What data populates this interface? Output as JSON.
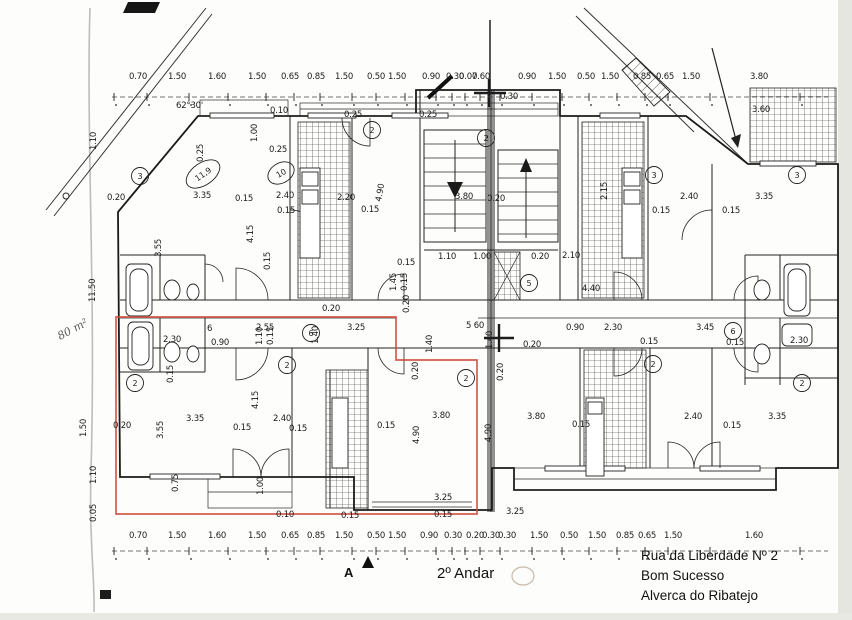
{
  "footer": {
    "floor_title": "2º Andar",
    "address1": "Rua da Liberdade Nº 2",
    "address2": "Bom Sucesso",
    "address3": "Alverca do Ribatejo"
  },
  "dimensions": {
    "tick_xs": [
      114,
      147,
      189,
      228,
      266,
      294,
      320,
      352,
      376,
      405,
      436,
      452,
      465,
      480,
      500,
      532,
      562,
      589,
      617,
      645,
      668,
      710,
      800
    ],
    "top": {
      "text_y": 79,
      "line_y": 97,
      "items": [
        {
          "t": "0.70",
          "x": 129
        },
        {
          "t": "1.50",
          "x": 168
        },
        {
          "t": "1.60",
          "x": 208
        },
        {
          "t": "1.50",
          "x": 248
        },
        {
          "t": "0.65",
          "x": 281
        },
        {
          "t": "0.85",
          "x": 307
        },
        {
          "t": "1.50",
          "x": 335
        },
        {
          "t": "0.50",
          "x": 367
        },
        {
          "t": "1.50",
          "x": 388
        },
        {
          "t": "0.90",
          "x": 422
        },
        {
          "t": "0.30",
          "x": 446
        },
        {
          "t": "0.07",
          "x": 459
        },
        {
          "t": "0.60",
          "x": 472
        },
        {
          "t": "0.90",
          "x": 518
        },
        {
          "t": "1.50",
          "x": 548
        },
        {
          "t": "0.50",
          "x": 577
        },
        {
          "t": "1.50",
          "x": 601
        },
        {
          "t": "0.85",
          "x": 633
        },
        {
          "t": "0.65",
          "x": 656
        },
        {
          "t": "1.50",
          "x": 682
        },
        {
          "t": "3.80",
          "x": 750
        }
      ]
    },
    "bottom": {
      "text_y": 538,
      "line_y": 551,
      "items": [
        {
          "t": "0.70",
          "x": 129
        },
        {
          "t": "1.50",
          "x": 168
        },
        {
          "t": "1.60",
          "x": 208
        },
        {
          "t": "1.50",
          "x": 248
        },
        {
          "t": "0.65",
          "x": 281
        },
        {
          "t": "0.85",
          "x": 307
        },
        {
          "t": "1.50",
          "x": 335
        },
        {
          "t": "0.50",
          "x": 367
        },
        {
          "t": "1.50",
          "x": 388
        },
        {
          "t": "0.90",
          "x": 420
        },
        {
          "t": "0.30",
          "x": 444
        },
        {
          "t": "0.20",
          "x": 466
        },
        {
          "t": "0.30",
          "x": 482
        },
        {
          "t": "0.30",
          "x": 498
        },
        {
          "t": "1.50",
          "x": 530
        },
        {
          "t": "0.50",
          "x": 560
        },
        {
          "t": "1.50",
          "x": 588
        },
        {
          "t": "0.85",
          "x": 616
        },
        {
          "t": "0.65",
          "x": 638
        },
        {
          "t": "1.50",
          "x": 664
        },
        {
          "t": "1.60",
          "x": 745
        }
      ]
    }
  },
  "plan": {
    "labels": [
      {
        "t": "62°30'",
        "x": 176,
        "y": 108
      },
      {
        "t": "1.10",
        "x": 96,
        "y": 150,
        "r": -90
      },
      {
        "t": "0.25",
        "x": 203,
        "y": 162,
        "r": -90
      },
      {
        "t": "0.10",
        "x": 270,
        "y": 113
      },
      {
        "t": "1.00",
        "x": 257,
        "y": 142,
        "r": -90
      },
      {
        "t": "0.25",
        "x": 269,
        "y": 152
      },
      {
        "t": "0.25",
        "x": 344,
        "y": 117
      },
      {
        "t": "0.25",
        "x": 419,
        "y": 117
      },
      {
        "t": "0.30",
        "x": 500,
        "y": 99
      },
      {
        "t": "3.60",
        "x": 752,
        "y": 112
      },
      {
        "t": "0.20",
        "x": 107,
        "y": 200
      },
      {
        "t": "3.35",
        "x": 193,
        "y": 198
      },
      {
        "t": "0.15",
        "x": 235,
        "y": 201
      },
      {
        "t": "2.40",
        "x": 276,
        "y": 198
      },
      {
        "t": "0.15",
        "x": 277,
        "y": 213
      },
      {
        "t": "2.20",
        "x": 337,
        "y": 200
      },
      {
        "t": "0.15",
        "x": 361,
        "y": 212
      },
      {
        "t": "4.90",
        "x": 381,
        "y": 202,
        "r": -80
      },
      {
        "t": "3.80",
        "x": 455,
        "y": 199
      },
      {
        "t": "0.20",
        "x": 487,
        "y": 201
      },
      {
        "t": "2.15",
        "x": 607,
        "y": 200,
        "r": -90
      },
      {
        "t": "2.40",
        "x": 680,
        "y": 199
      },
      {
        "t": "0.15",
        "x": 652,
        "y": 213
      },
      {
        "t": "3.35",
        "x": 755,
        "y": 199
      },
      {
        "t": "0.15",
        "x": 722,
        "y": 213
      },
      {
        "t": "3.55",
        "x": 161,
        "y": 257,
        "r": -90
      },
      {
        "t": "4.15",
        "x": 253,
        "y": 243,
        "r": -90
      },
      {
        "t": "0.15",
        "x": 270,
        "y": 270,
        "r": -90
      },
      {
        "t": "4.40",
        "x": 582,
        "y": 291
      },
      {
        "t": "1.10",
        "x": 438,
        "y": 259
      },
      {
        "t": "1.00",
        "x": 473,
        "y": 259
      },
      {
        "t": "0.20",
        "x": 531,
        "y": 259
      },
      {
        "t": "2.10",
        "x": 562,
        "y": 258
      },
      {
        "t": "0.15",
        "x": 397,
        "y": 265
      },
      {
        "t": "1.45",
        "x": 396,
        "y": 291,
        "r": -90
      },
      {
        "t": "0.15",
        "x": 407,
        "y": 291,
        "r": -90
      },
      {
        "t": "0.20",
        "x": 409,
        "y": 313,
        "r": -90
      },
      {
        "t": "0.20",
        "x": 322,
        "y": 311
      },
      {
        "t": "6",
        "x": 207,
        "y": 331
      },
      {
        "t": "2.55",
        "x": 256,
        "y": 330
      },
      {
        "t": "0.90",
        "x": 211,
        "y": 345
      },
      {
        "t": "1.10",
        "x": 262,
        "y": 345,
        "r": -90
      },
      {
        "t": "0.15",
        "x": 273,
        "y": 345,
        "r": -90
      },
      {
        "t": "3.25",
        "x": 347,
        "y": 330
      },
      {
        "t": "1.40",
        "x": 318,
        "y": 344,
        "r": -90
      },
      {
        "t": "5 60",
        "x": 466,
        "y": 328
      },
      {
        "t": "1.40",
        "x": 432,
        "y": 353,
        "r": -90
      },
      {
        "t": "1.40",
        "x": 492,
        "y": 349,
        "r": -90
      },
      {
        "t": "0.90",
        "x": 566,
        "y": 330
      },
      {
        "t": "0.20",
        "x": 523,
        "y": 347
      },
      {
        "t": "2.30",
        "x": 604,
        "y": 330
      },
      {
        "t": "3.45",
        "x": 696,
        "y": 330
      },
      {
        "t": "0.15",
        "x": 640,
        "y": 344
      },
      {
        "t": "0.15",
        "x": 726,
        "y": 345
      },
      {
        "t": "2.30",
        "x": 790,
        "y": 343
      },
      {
        "t": "11.50",
        "x": 95,
        "y": 302,
        "r": -90
      },
      {
        "t": "80 m²",
        "x": 60,
        "y": 340,
        "r": -28,
        "hand": true
      },
      {
        "t": "1.50",
        "x": 86,
        "y": 437,
        "r": -90
      },
      {
        "t": "1.10",
        "x": 96,
        "y": 484,
        "r": -90
      },
      {
        "t": "0.05",
        "x": 96,
        "y": 522,
        "r": -90
      },
      {
        "t": "2.30",
        "x": 163,
        "y": 342
      },
      {
        "t": "0.15",
        "x": 173,
        "y": 383,
        "r": -90
      },
      {
        "t": "3.55",
        "x": 163,
        "y": 439,
        "r": -90
      },
      {
        "t": "3.35",
        "x": 186,
        "y": 421
      },
      {
        "t": "0.15",
        "x": 233,
        "y": 430
      },
      {
        "t": "4.15",
        "x": 258,
        "y": 409,
        "r": -90
      },
      {
        "t": "2.40",
        "x": 273,
        "y": 421
      },
      {
        "t": "0.15",
        "x": 289,
        "y": 431
      },
      {
        "t": "0.20",
        "x": 113,
        "y": 428
      },
      {
        "t": "1.00",
        "x": 263,
        "y": 495,
        "r": -90
      },
      {
        "t": "0.75",
        "x": 178,
        "y": 492,
        "r": -90
      },
      {
        "t": "0.20",
        "x": 418,
        "y": 380,
        "r": -90
      },
      {
        "t": "0.20",
        "x": 503,
        "y": 381,
        "r": -90
      },
      {
        "t": "3.80",
        "x": 432,
        "y": 418
      },
      {
        "t": "0.15",
        "x": 377,
        "y": 428
      },
      {
        "t": "4.90",
        "x": 419,
        "y": 444,
        "r": -90
      },
      {
        "t": "4.90",
        "x": 491,
        "y": 442,
        "r": -90
      },
      {
        "t": "3.25",
        "x": 434,
        "y": 500
      },
      {
        "t": "0.10",
        "x": 276,
        "y": 517
      },
      {
        "t": "0.15",
        "x": 341,
        "y": 518
      },
      {
        "t": "0.15",
        "x": 434,
        "y": 517
      },
      {
        "t": "3.80",
        "x": 527,
        "y": 419
      },
      {
        "t": "0.15",
        "x": 572,
        "y": 427
      },
      {
        "t": "2.40",
        "x": 684,
        "y": 419
      },
      {
        "t": "0.15",
        "x": 723,
        "y": 428
      },
      {
        "t": "3.35",
        "x": 768,
        "y": 419
      },
      {
        "t": "3.25",
        "x": 506,
        "y": 514
      },
      {
        "t": "A",
        "x": 344,
        "y": 577,
        "b": true
      }
    ],
    "circled": [
      {
        "t": "3",
        "x": 140,
        "y": 176
      },
      {
        "t": "2",
        "x": 372,
        "y": 130
      },
      {
        "t": "2",
        "x": 486,
        "y": 138
      },
      {
        "t": "3",
        "x": 654,
        "y": 175
      },
      {
        "t": "3",
        "x": 797,
        "y": 175
      },
      {
        "t": "5",
        "x": 529,
        "y": 283
      },
      {
        "t": "6",
        "x": 311,
        "y": 333
      },
      {
        "t": "6",
        "x": 733,
        "y": 331
      },
      {
        "t": "2",
        "x": 135,
        "y": 383
      },
      {
        "t": "2",
        "x": 287,
        "y": 365
      },
      {
        "t": "2",
        "x": 466,
        "y": 378
      },
      {
        "t": "2",
        "x": 653,
        "y": 364
      },
      {
        "t": "2",
        "x": 802,
        "y": 383
      }
    ],
    "ovals": [
      {
        "t": "11,9",
        "x": 203,
        "y": 174,
        "rx": 19,
        "ry": 11,
        "rot": -35
      },
      {
        "t": "10",
        "x": 281,
        "y": 173,
        "rx": 14,
        "ry": 10,
        "rot": -30
      }
    ]
  }
}
